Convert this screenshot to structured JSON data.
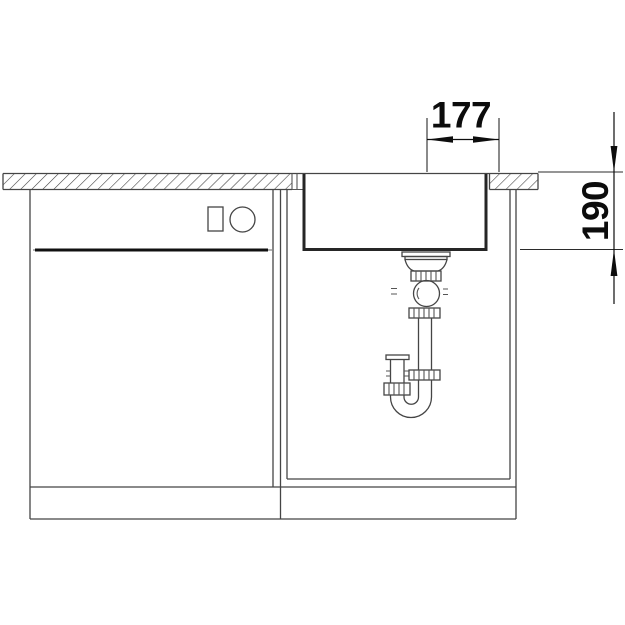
{
  "dimensions": {
    "width": {
      "label": "177"
    },
    "depth": {
      "label": "190"
    }
  },
  "colors": {
    "background": "#ffffff",
    "line": "#454545",
    "bold_line": "#262626",
    "dimension": "#0d0d0d"
  }
}
